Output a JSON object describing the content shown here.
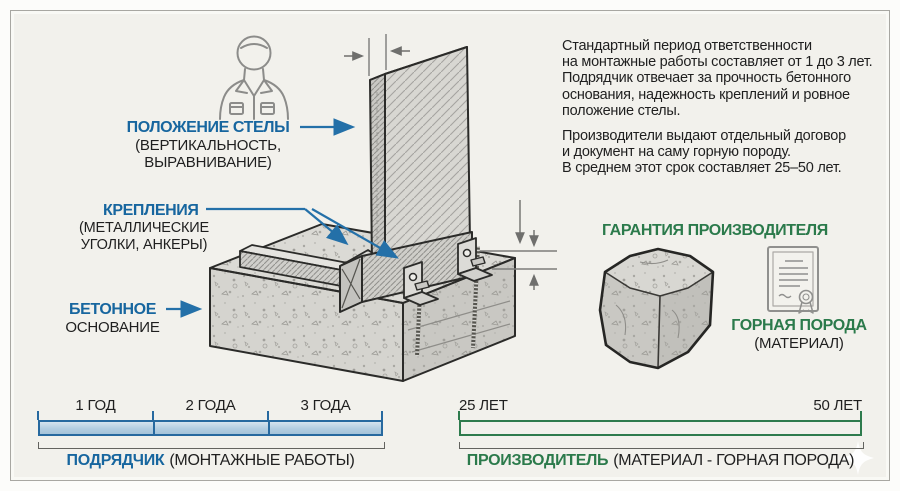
{
  "colors": {
    "accent_blue": "#17669f",
    "accent_green": "#2b7a4b",
    "bar_blue_fill": "#b3cde1",
    "bar_blue_border": "#27699f",
    "bar_green_fill": "#bdd8c6",
    "bar_green_border": "#2e7b4d",
    "background": "#f2f1ec",
    "text_dark": "#1f1f1f"
  },
  "callouts": {
    "stele": {
      "title": "ПОЛОЖЕНИЕ СТЕЛЫ",
      "line2": "(ВЕРТИКАЛЬНОСТЬ,",
      "line3": "ВЫРАВНИВАНИЕ)"
    },
    "fasteners": {
      "title": "КРЕПЛЕНИЯ",
      "line2": "(МЕТАЛЛИЧЕСКИЕ",
      "line3": "УГОЛКИ, АНКЕРЫ)"
    },
    "foundation": {
      "line1": "БЕТОННОЕ",
      "line2": "ОСНОВАНИЕ"
    }
  },
  "info_text": {
    "para1_lines": [
      "Стандартный период ответственности",
      "на монтажные работы составляет от 1 до 3 лет.",
      "Подрядчик отвечает за прочность бетонного",
      "основания, надежность креплений и ровное",
      "положение стелы."
    ],
    "para2_lines": [
      "Производители выдают отдельный договор",
      "и документ на саму горную породу.",
      "В среднем этот срок составляет 25–50 лет."
    ]
  },
  "manufacturer_warranty": {
    "title": "ГАРАНТИЯ ПРОИЗВОДИТЕЛЯ",
    "material_title": "ГОРНАЯ ПОРОДА",
    "material_subtitle": "(МАТЕРИАЛ)"
  },
  "contractor_timeline": {
    "segments": [
      "1 ГОД",
      "2 ГОДА",
      "3 ГОДА"
    ],
    "caption_bold": "ПОДРЯДЧИК",
    "caption_rest": "(МОНТАЖНЫЕ РАБОТЫ)"
  },
  "manufacturer_timeline": {
    "start": "25 ЛЕТ",
    "end": "50 ЛЕТ",
    "caption_bold": "ПРОИЗВОДИТЕЛЬ",
    "caption_rest": "(МАТЕРИАЛ - ГОРНАЯ ПОРОДА)"
  },
  "icons": {
    "worker": "worker-icon",
    "stone": "stone-block-icon",
    "certificate": "certificate-icon",
    "sparkle": "sparkle-icon"
  }
}
